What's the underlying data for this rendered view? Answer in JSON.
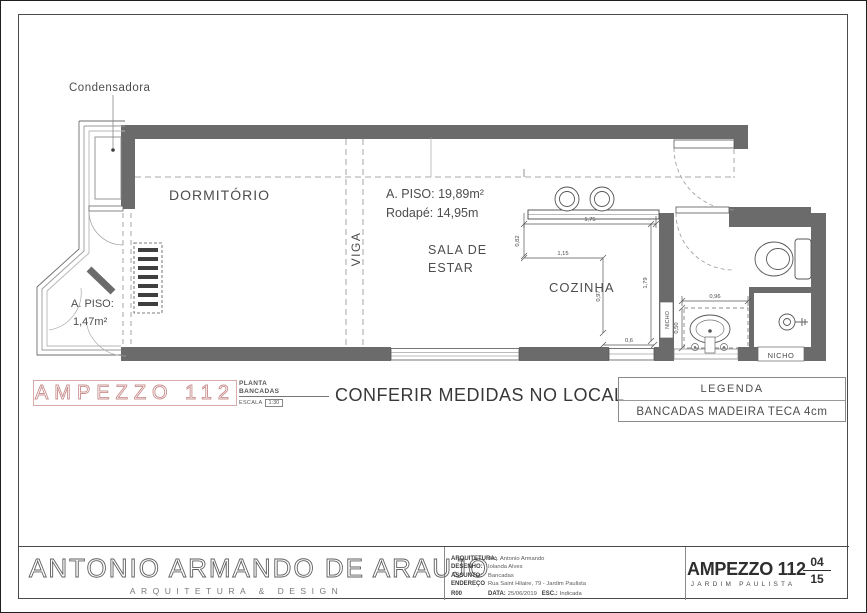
{
  "plan": {
    "condenser": "Condensadora",
    "dormitorio": "DORMITÓRIO",
    "viga": "VIGA",
    "area_line1": "A. PISO: 19,89m²",
    "area_line2": "Rodapé: 14,95m",
    "sala1": "SALA DE",
    "sala2": "ESTAR",
    "cozinha": "COZINHA",
    "bay_area1": "A. PISO:",
    "bay_area2": "1,47m²",
    "nicho_wall": "NICHO",
    "nicho_shower": "NICHO",
    "dims": {
      "counter_front": "1,75",
      "counter_side": "0,82",
      "inner_width": "1,15",
      "inner_depth": "0,97",
      "bottom_gap": "0,6",
      "kitchen_depth": "1,79",
      "bath_counter_width": "0,96",
      "bath_counter_depth": "0,50"
    }
  },
  "strip": {
    "project_outline": "AMPEZZO 112",
    "sheet_name_line1": "PLANTA",
    "sheet_name_line2": "BANCADAS",
    "escala_label": "ESCALA",
    "escala_value": "1:30",
    "warning": "CONFERIR MEDIDAS NO LOCAL"
  },
  "legend": {
    "title": "LEGENDA",
    "item": "BANCADAS MADEIRA TECA 4cm"
  },
  "titleblock": {
    "logo_line1": "ANTONIO ARMANDO DE ARAUJO",
    "logo_line2": "ARQUITETURA & DESIGN",
    "fields": [
      {
        "label": "ARQUITETURA:",
        "value": "Arq. Antonio Armando"
      },
      {
        "label": "DESENHO:",
        "value": "Iolanda Alves"
      },
      {
        "label": "ASSUNTO:",
        "value": "Bancadas"
      },
      {
        "label": "ENDEREÇO",
        "value": "Rua Saint Hilaire, 79 - Jardim Paulista"
      }
    ],
    "revision": "R00",
    "data_label": "DATA:",
    "data_value": "25/06/2019",
    "esc_label": "ESC.:",
    "esc_value": "Indicada",
    "project": "AMPEZZO 112",
    "district": "JARDIM PAULISTA",
    "sheet_num": "04",
    "sheet_total": "15"
  },
  "colors": {
    "wall": "#6b6b6b",
    "accent": "#c98f8f",
    "line": "#555555"
  }
}
